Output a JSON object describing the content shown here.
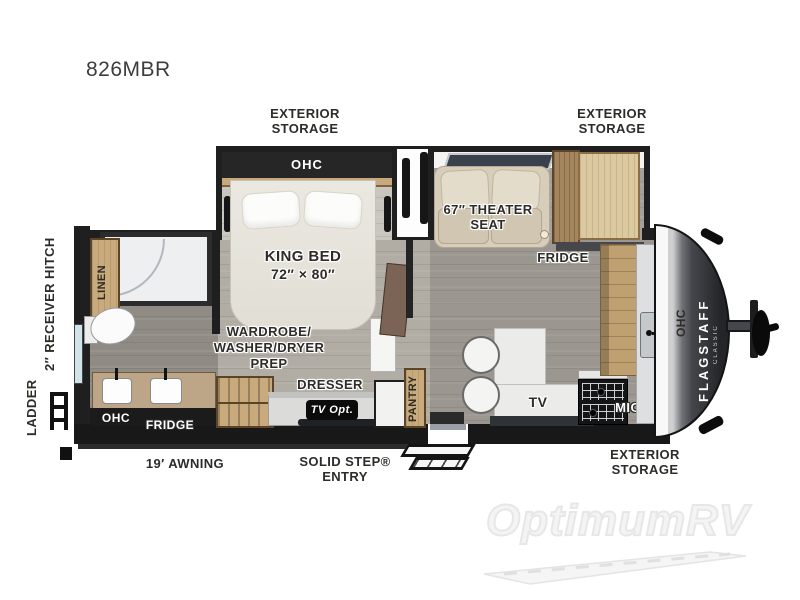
{
  "model": "826MBR",
  "watermark": "OptimumRV",
  "labels": {
    "exterior_storage": [
      "EXTERIOR",
      "STORAGE"
    ],
    "ohc": "OHC",
    "king_bed": [
      "KING BED",
      "72″ × 80″"
    ],
    "theater_seat": [
      "67″ THEATER",
      "SEAT"
    ],
    "fridge": "FRIDGE",
    "linen": "LINEN",
    "receiver_hitch": "2″ RECEIVER HITCH",
    "ladder": "LADDER",
    "wardrobe_prep": [
      "WARDROBE/",
      "WASHER/DRYER",
      "PREP"
    ],
    "dresser": "DRESSER",
    "tv_opt": "TV Opt.",
    "pantry": "PANTRY",
    "tv": "TV",
    "micro": "MICRO",
    "awning": "19′ AWNING",
    "solid_step": [
      "SOLID STEP®",
      "ENTRY"
    ],
    "brand": "FLAGSTAFF",
    "brand_sub": "CLASSIC"
  },
  "colors": {
    "wall": "#1f1f1f",
    "wood": "#c9aa7d",
    "wood_dark": "#a4855c",
    "floor_living": "#9b9790",
    "floor_bedroom": "#b1ada4",
    "floor_bath": "#908c85",
    "bed": "#e9e6df",
    "theater_seat": "#d8cdbb",
    "front_cap": "#3c3d41",
    "label_text": "#2e2c29"
  }
}
